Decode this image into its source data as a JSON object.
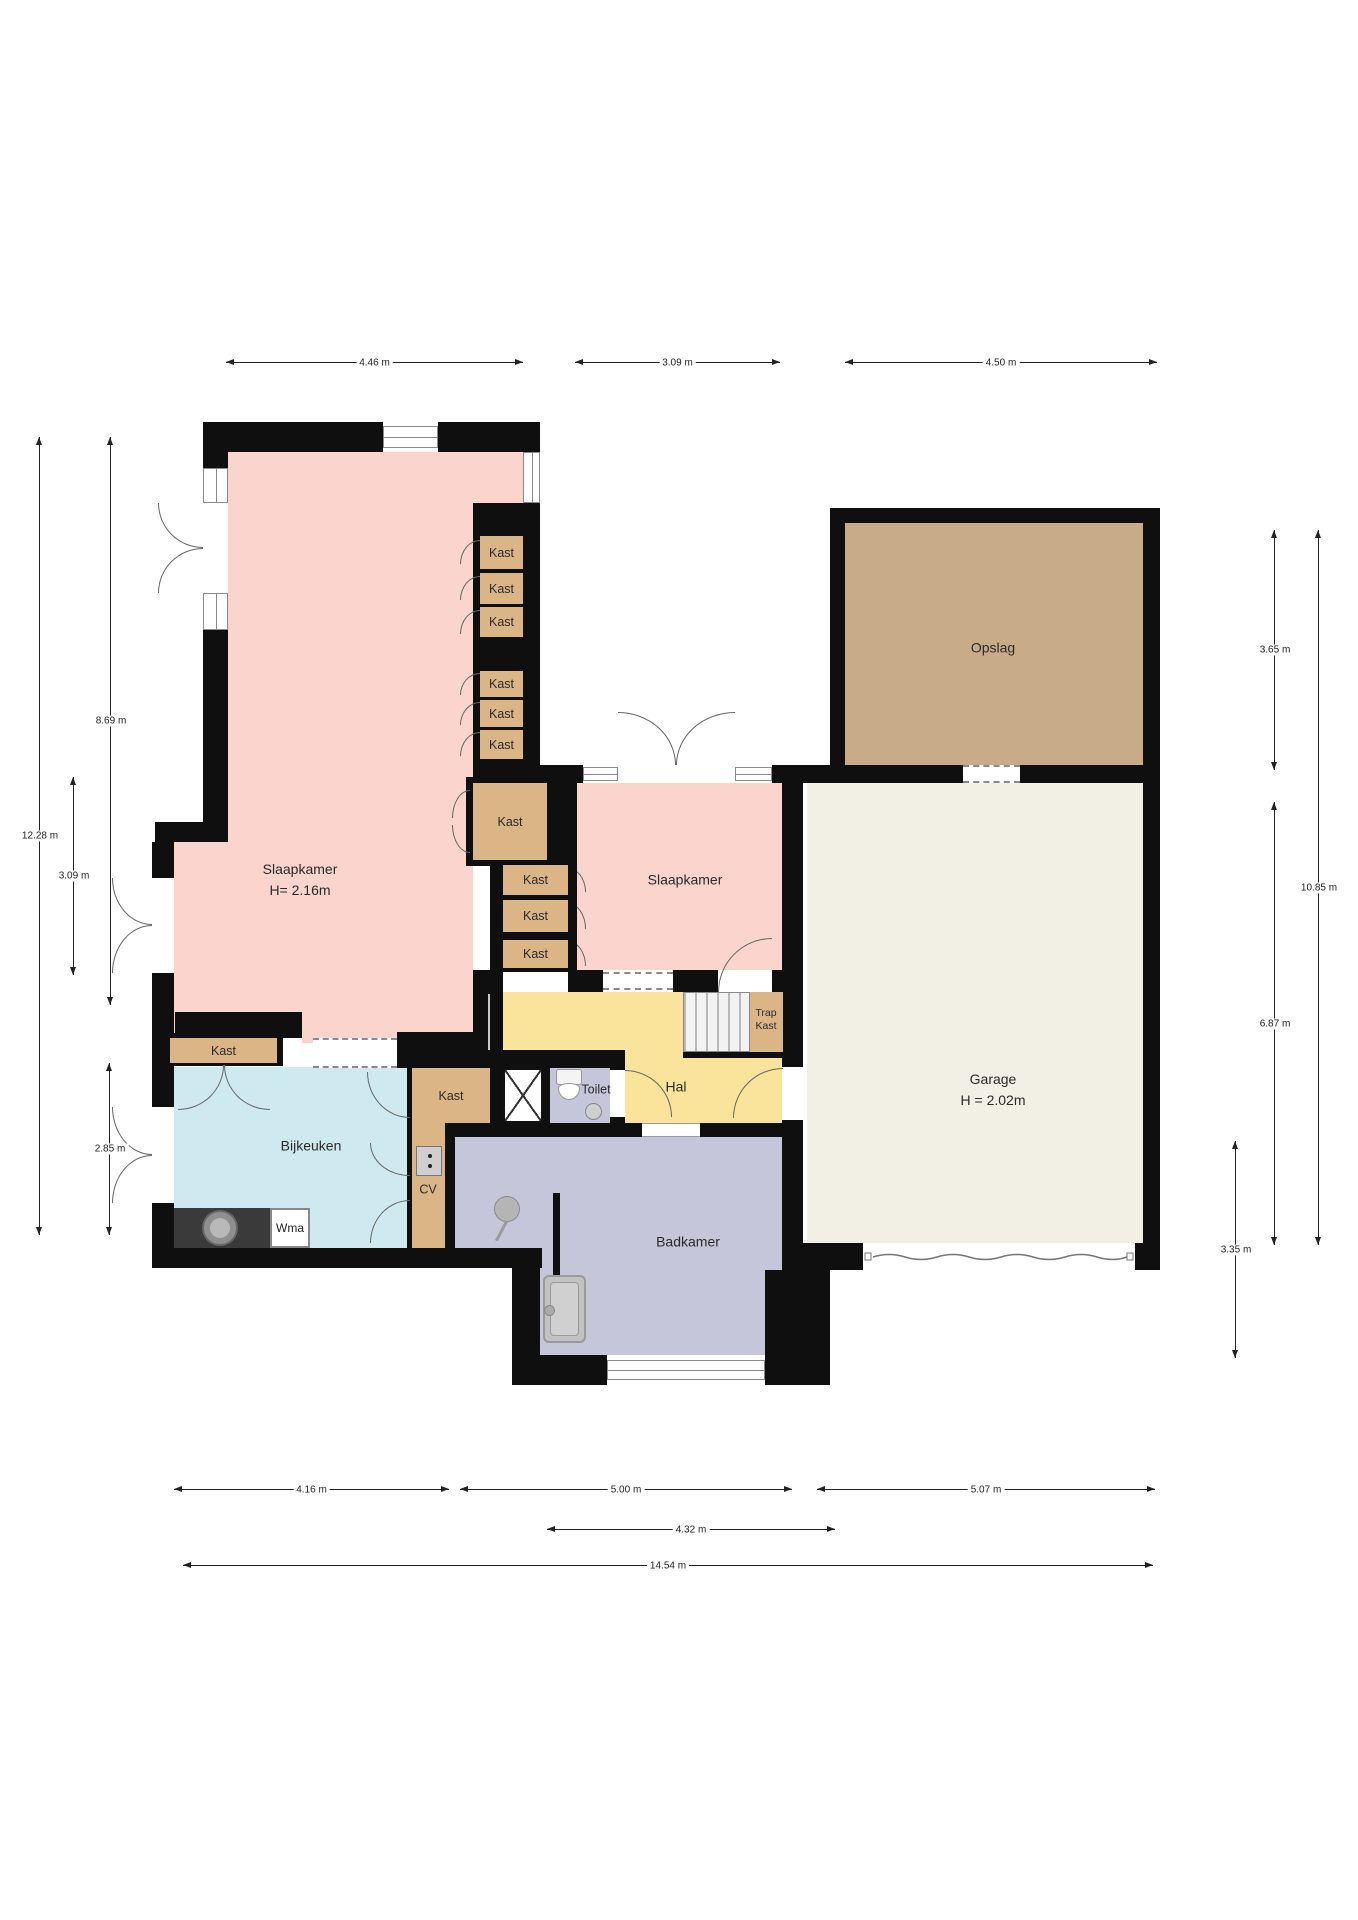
{
  "plan_title": "floor-plan",
  "rooms": {
    "slaapkamer_main": {
      "label": "Slaapkamer",
      "height_label": "H= 2.16m"
    },
    "slaapkamer_2": {
      "label": "Slaapkamer"
    },
    "opslag": {
      "label": "Opslag"
    },
    "garage": {
      "label": "Garage",
      "height_label": "H = 2.02m"
    },
    "hal": {
      "label": "Hal"
    },
    "toilet": {
      "label": "Toilet"
    },
    "badkamer": {
      "label": "Badkamer"
    },
    "bijkeuken": {
      "label": "Bijkeuken"
    },
    "trap_kast": {
      "line1": "Trap",
      "line2": "Kast"
    },
    "cv": {
      "label": "CV"
    },
    "wma": {
      "label": "Wma"
    }
  },
  "kasts": [
    {
      "label": "Kast"
    },
    {
      "label": "Kast"
    },
    {
      "label": "Kast"
    },
    {
      "label": "Kast"
    },
    {
      "label": "Kast"
    },
    {
      "label": "Kast"
    },
    {
      "label": "Kast"
    },
    {
      "label": "Kast"
    },
    {
      "label": "Kast"
    },
    {
      "label": "Kast"
    },
    {
      "label": "Kast"
    },
    {
      "label": "Kast"
    }
  ],
  "dimensions": {
    "top": [
      {
        "label": "4.46 m"
      },
      {
        "label": "3.09 m"
      },
      {
        "label": "4.50 m"
      }
    ],
    "left": [
      {
        "label": "12.28 m"
      },
      {
        "label": "8.69 m"
      },
      {
        "label": "3.09 m"
      },
      {
        "label": "2.85 m"
      }
    ],
    "right": [
      {
        "label": "3.65 m"
      },
      {
        "label": "10.85 m"
      },
      {
        "label": "6.87 m"
      },
      {
        "label": "3.35 m"
      }
    ],
    "bottom": [
      {
        "label": "4.16 m"
      },
      {
        "label": "5.00 m"
      },
      {
        "label": "5.07 m"
      },
      {
        "label": "4.32 m"
      },
      {
        "label": "14.54 m"
      }
    ]
  },
  "colors": {
    "wall": "#0f0f0f",
    "bedroom_pink": "#fbd4cd",
    "closet_tan": "#dbb586",
    "opslag_tan": "#c8ab87",
    "garage_cream": "#f2f0e5",
    "hal_yellow": "#fae49b",
    "bath_lavender": "#c6c6da",
    "bijkeuken_cyan": "#cfe9f0"
  }
}
